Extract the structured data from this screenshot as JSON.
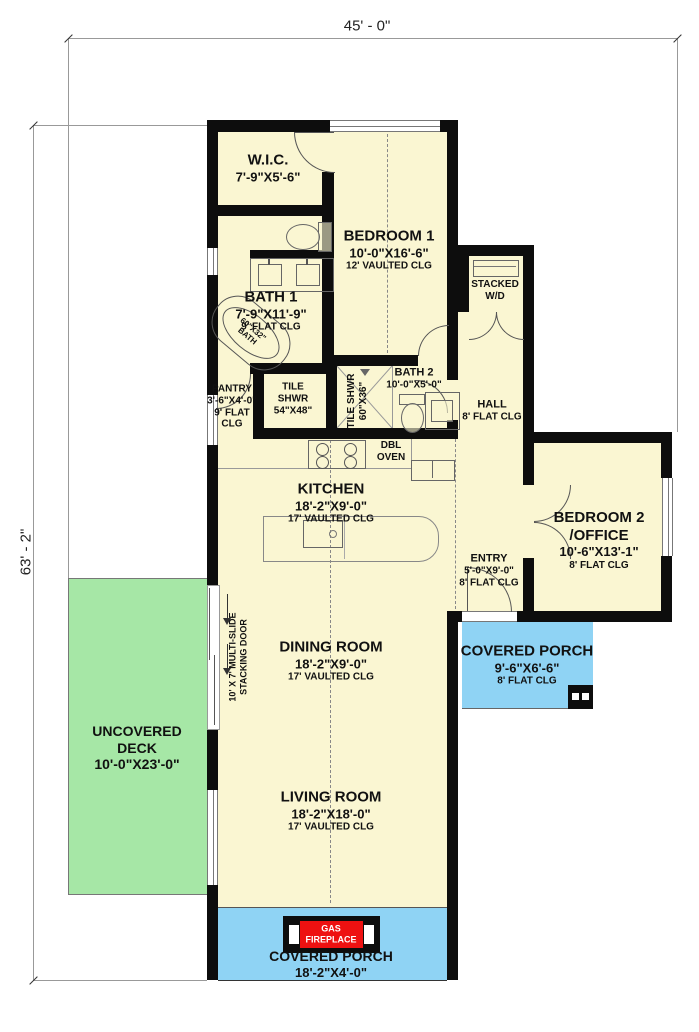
{
  "dimensions": {
    "width": "45' - 0\"",
    "height": "63' - 2\""
  },
  "rooms": {
    "wic": {
      "name": "W.I.C.",
      "size": "7'-9\"X5'-6\""
    },
    "bedroom1": {
      "name": "BEDROOM 1",
      "size": "10'-0\"X16'-6\"",
      "ceiling": "12' VAULTED CLG"
    },
    "bath1": {
      "name": "BATH 1",
      "size": "7'-9\"X11'-9\"",
      "ceiling": "9' FLAT CLG"
    },
    "bath2": {
      "name": "BATH 2",
      "size": "10'-0\"X5'-0\""
    },
    "hall": {
      "name": "HALL",
      "ceiling": "8' FLAT CLG"
    },
    "pantry": {
      "name": "PANTRY",
      "size": "3'-6\"X4'-0\"",
      "ceiling": "9' FLAT CLG"
    },
    "kitchen": {
      "name": "KITCHEN",
      "size": "18'-2\"X9'-0\"",
      "ceiling": "17' VAULTED CLG"
    },
    "bedroom2": {
      "name": "BEDROOM 2",
      "name2": "/OFFICE",
      "size": "10'-6\"X13'-1\"",
      "ceiling": "8' FLAT CLG"
    },
    "entry": {
      "name": "ENTRY",
      "size": "5'-0\"X9'-0\"",
      "ceiling": "8' FLAT CLG"
    },
    "porch_right": {
      "name": "COVERED PORCH",
      "size": "9'-6\"X6'-6\"",
      "ceiling": "8' FLAT CLG"
    },
    "dining": {
      "name": "DINING ROOM",
      "size": "18'-2\"X9'-0\"",
      "ceiling": "17' VAULTED CLG"
    },
    "deck": {
      "name": "UNCOVERED DECK",
      "size": "10'-0\"X23'-0\""
    },
    "living": {
      "name": "LIVING ROOM",
      "size": "18'-2\"X18'-0\"",
      "ceiling": "17' VAULTED CLG"
    },
    "porch_bottom": {
      "name": "COVERED PORCH",
      "size": "18'-2\"X4'-0\""
    }
  },
  "fixtures": {
    "stacked_wd": "STACKED W/D",
    "dbl_oven": "DBL OVEN",
    "tile_shwr_main": "TILE SHWR 54\"X48\"",
    "tile_shwr2_l1": "TILE SHWR",
    "tile_shwr2_l2": "60\"X36\"",
    "tub_l1": "60\"X32\"",
    "tub_l2": "BATH",
    "fireplace_l1": "GAS",
    "fireplace_l2": "FIREPLACE",
    "multislide_l1": "10' X 7' MULTI-SLIDE",
    "multislide_l2": "STACKING DOOR"
  },
  "colors": {
    "floor": "#faf6d2",
    "deck": "#a6e7a6",
    "porch": "#8fd3f4",
    "fireplace_red": "#ee1111",
    "wall": "#0d0d0d"
  }
}
